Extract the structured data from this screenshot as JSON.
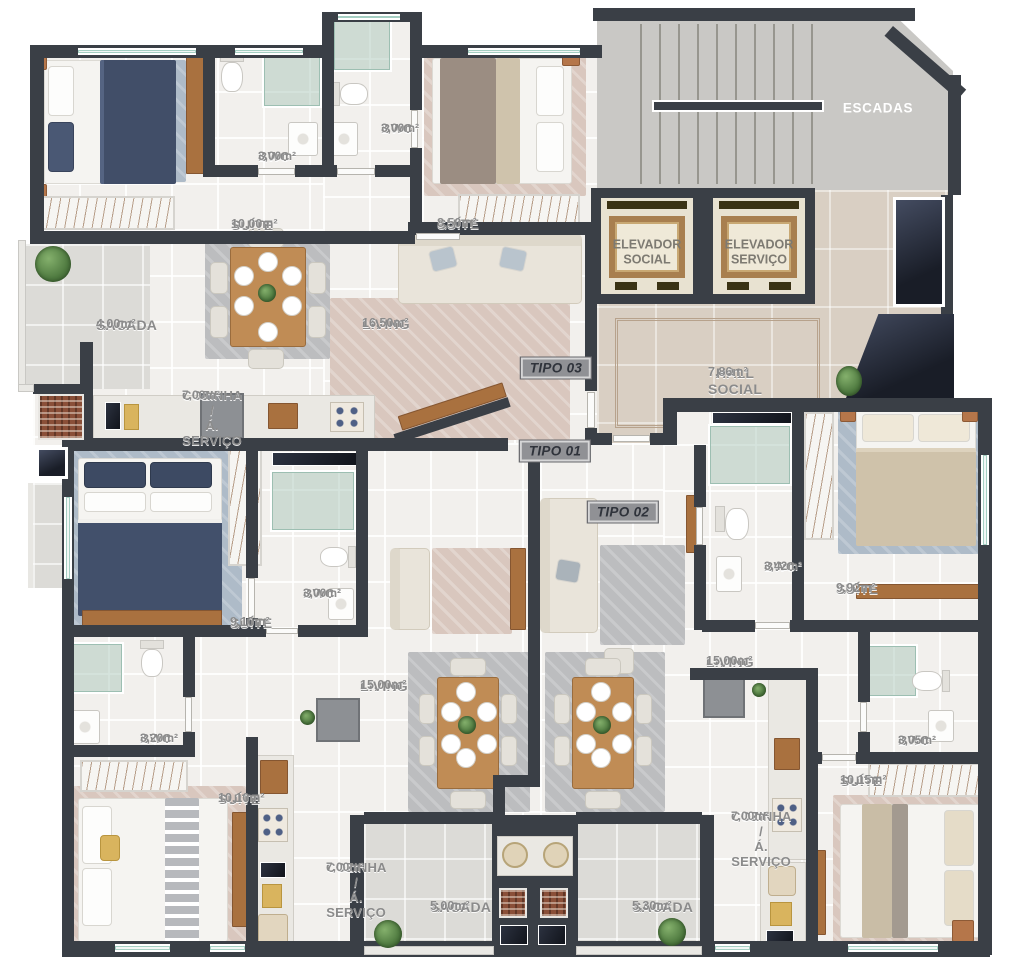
{
  "plan_title": "Planta do pavimento tipo",
  "rooms": [
    {
      "name": "SUÍTE",
      "area": "10,00m²"
    },
    {
      "name": "BWC",
      "area": "3,00m²"
    },
    {
      "name": "BWC",
      "area": "3,00m²"
    },
    {
      "name": "SUÍTE",
      "area": "8,50m²"
    },
    {
      "name": "SACADA",
      "area": "4,00m²"
    },
    {
      "name": "LIVING",
      "area": "16,50m²"
    },
    {
      "name": "HALL SOCIAL",
      "area": "7,86m²"
    },
    {
      "name": "COZINHA /\nÁ. SERVIÇO",
      "area": "7,00m²"
    },
    {
      "name": "SUÍTE",
      "area": "9,10m²"
    },
    {
      "name": "BWC",
      "area": "3,00m²"
    },
    {
      "name": "LIVING",
      "area": "15,00m²"
    },
    {
      "name": "BWC",
      "area": "3,20m²"
    },
    {
      "name": "SUÍTE",
      "area": "10,10m²"
    },
    {
      "name": "COZINHA /\nÁ. SERVIÇO",
      "area": "7,00m²"
    },
    {
      "name": "SACADA",
      "area": "5,00m²"
    },
    {
      "name": "SACADA",
      "area": "5,30m²"
    },
    {
      "name": "BWC",
      "area": "3,42m²"
    },
    {
      "name": "SUÍTE",
      "area": "9,92m²"
    },
    {
      "name": "LIVING",
      "area": "15,00m²"
    },
    {
      "name": "COZINHA /\nÁ. SERVIÇO",
      "area": "7,00m²"
    },
    {
      "name": "BWC",
      "area": "3,05m²"
    },
    {
      "name": "SUÍTE",
      "area": "10,15m²"
    }
  ],
  "core": {
    "escadas": "ESCADAS",
    "elevador_social": "ELEVADOR\nSOCIAL",
    "elevador_servico": "ELEVADOR\nSERVIÇO"
  },
  "badges": [
    {
      "label": "TIPO 03"
    },
    {
      "label": "TIPO 01"
    },
    {
      "label": "TIPO 02"
    }
  ],
  "colors": {
    "wall": "#3a3f46",
    "floor": "#f2f0ed",
    "hall_floor": "#d9cfc3",
    "balcony_floor": "#dcdbd7",
    "wood_accent": "#a9713f",
    "label_gray": "#8b8b8b",
    "shaft_navy": "#191d27"
  }
}
